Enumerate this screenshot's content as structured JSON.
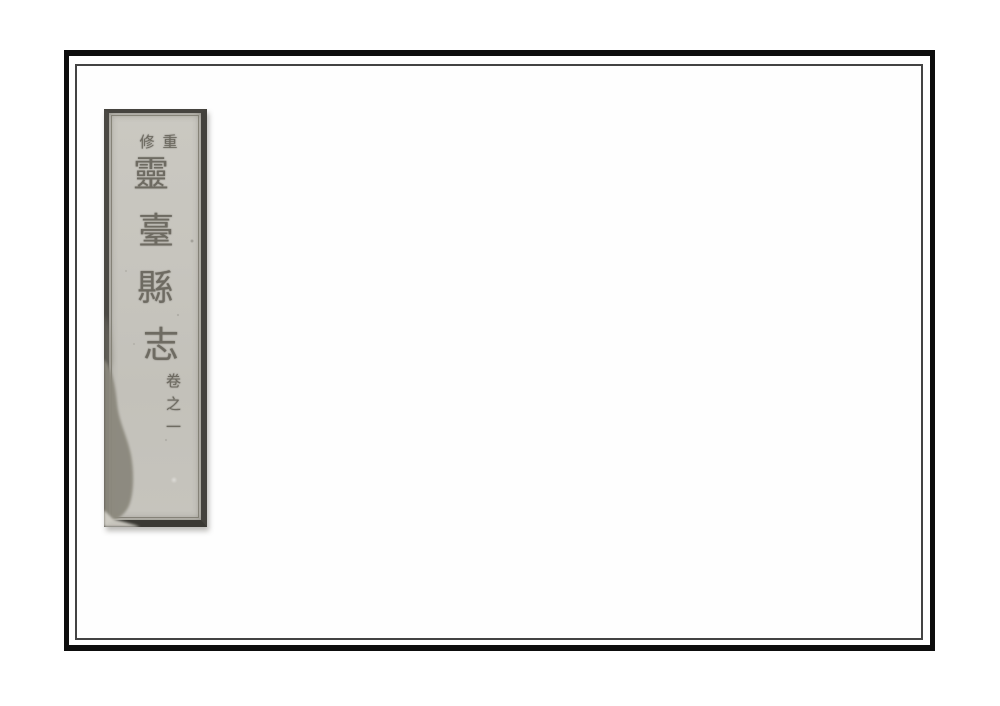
{
  "page": {
    "description": "Scanned title page of a traditional Chinese string-bound book: blank white leaf with a double-ruled black frame and a pasted title label strip at upper left",
    "background_color": "#ffffff"
  },
  "frame": {
    "outer_border_color": "#0d0d0d",
    "inner_line_color": "#434343"
  },
  "spine_label": {
    "background_color": "#c7c5be",
    "border_color": "#44423d",
    "ink_color": "#6e6b62",
    "stain_color": "#8b887d",
    "prefix": {
      "reading": "重修",
      "display_left": "修",
      "display_right": "重"
    },
    "title_chars": [
      "靈",
      "臺",
      "縣",
      "志"
    ],
    "volume_chars": [
      "卷",
      "之",
      "一"
    ],
    "full_title_reading": "重修靈臺縣志 卷之一"
  }
}
